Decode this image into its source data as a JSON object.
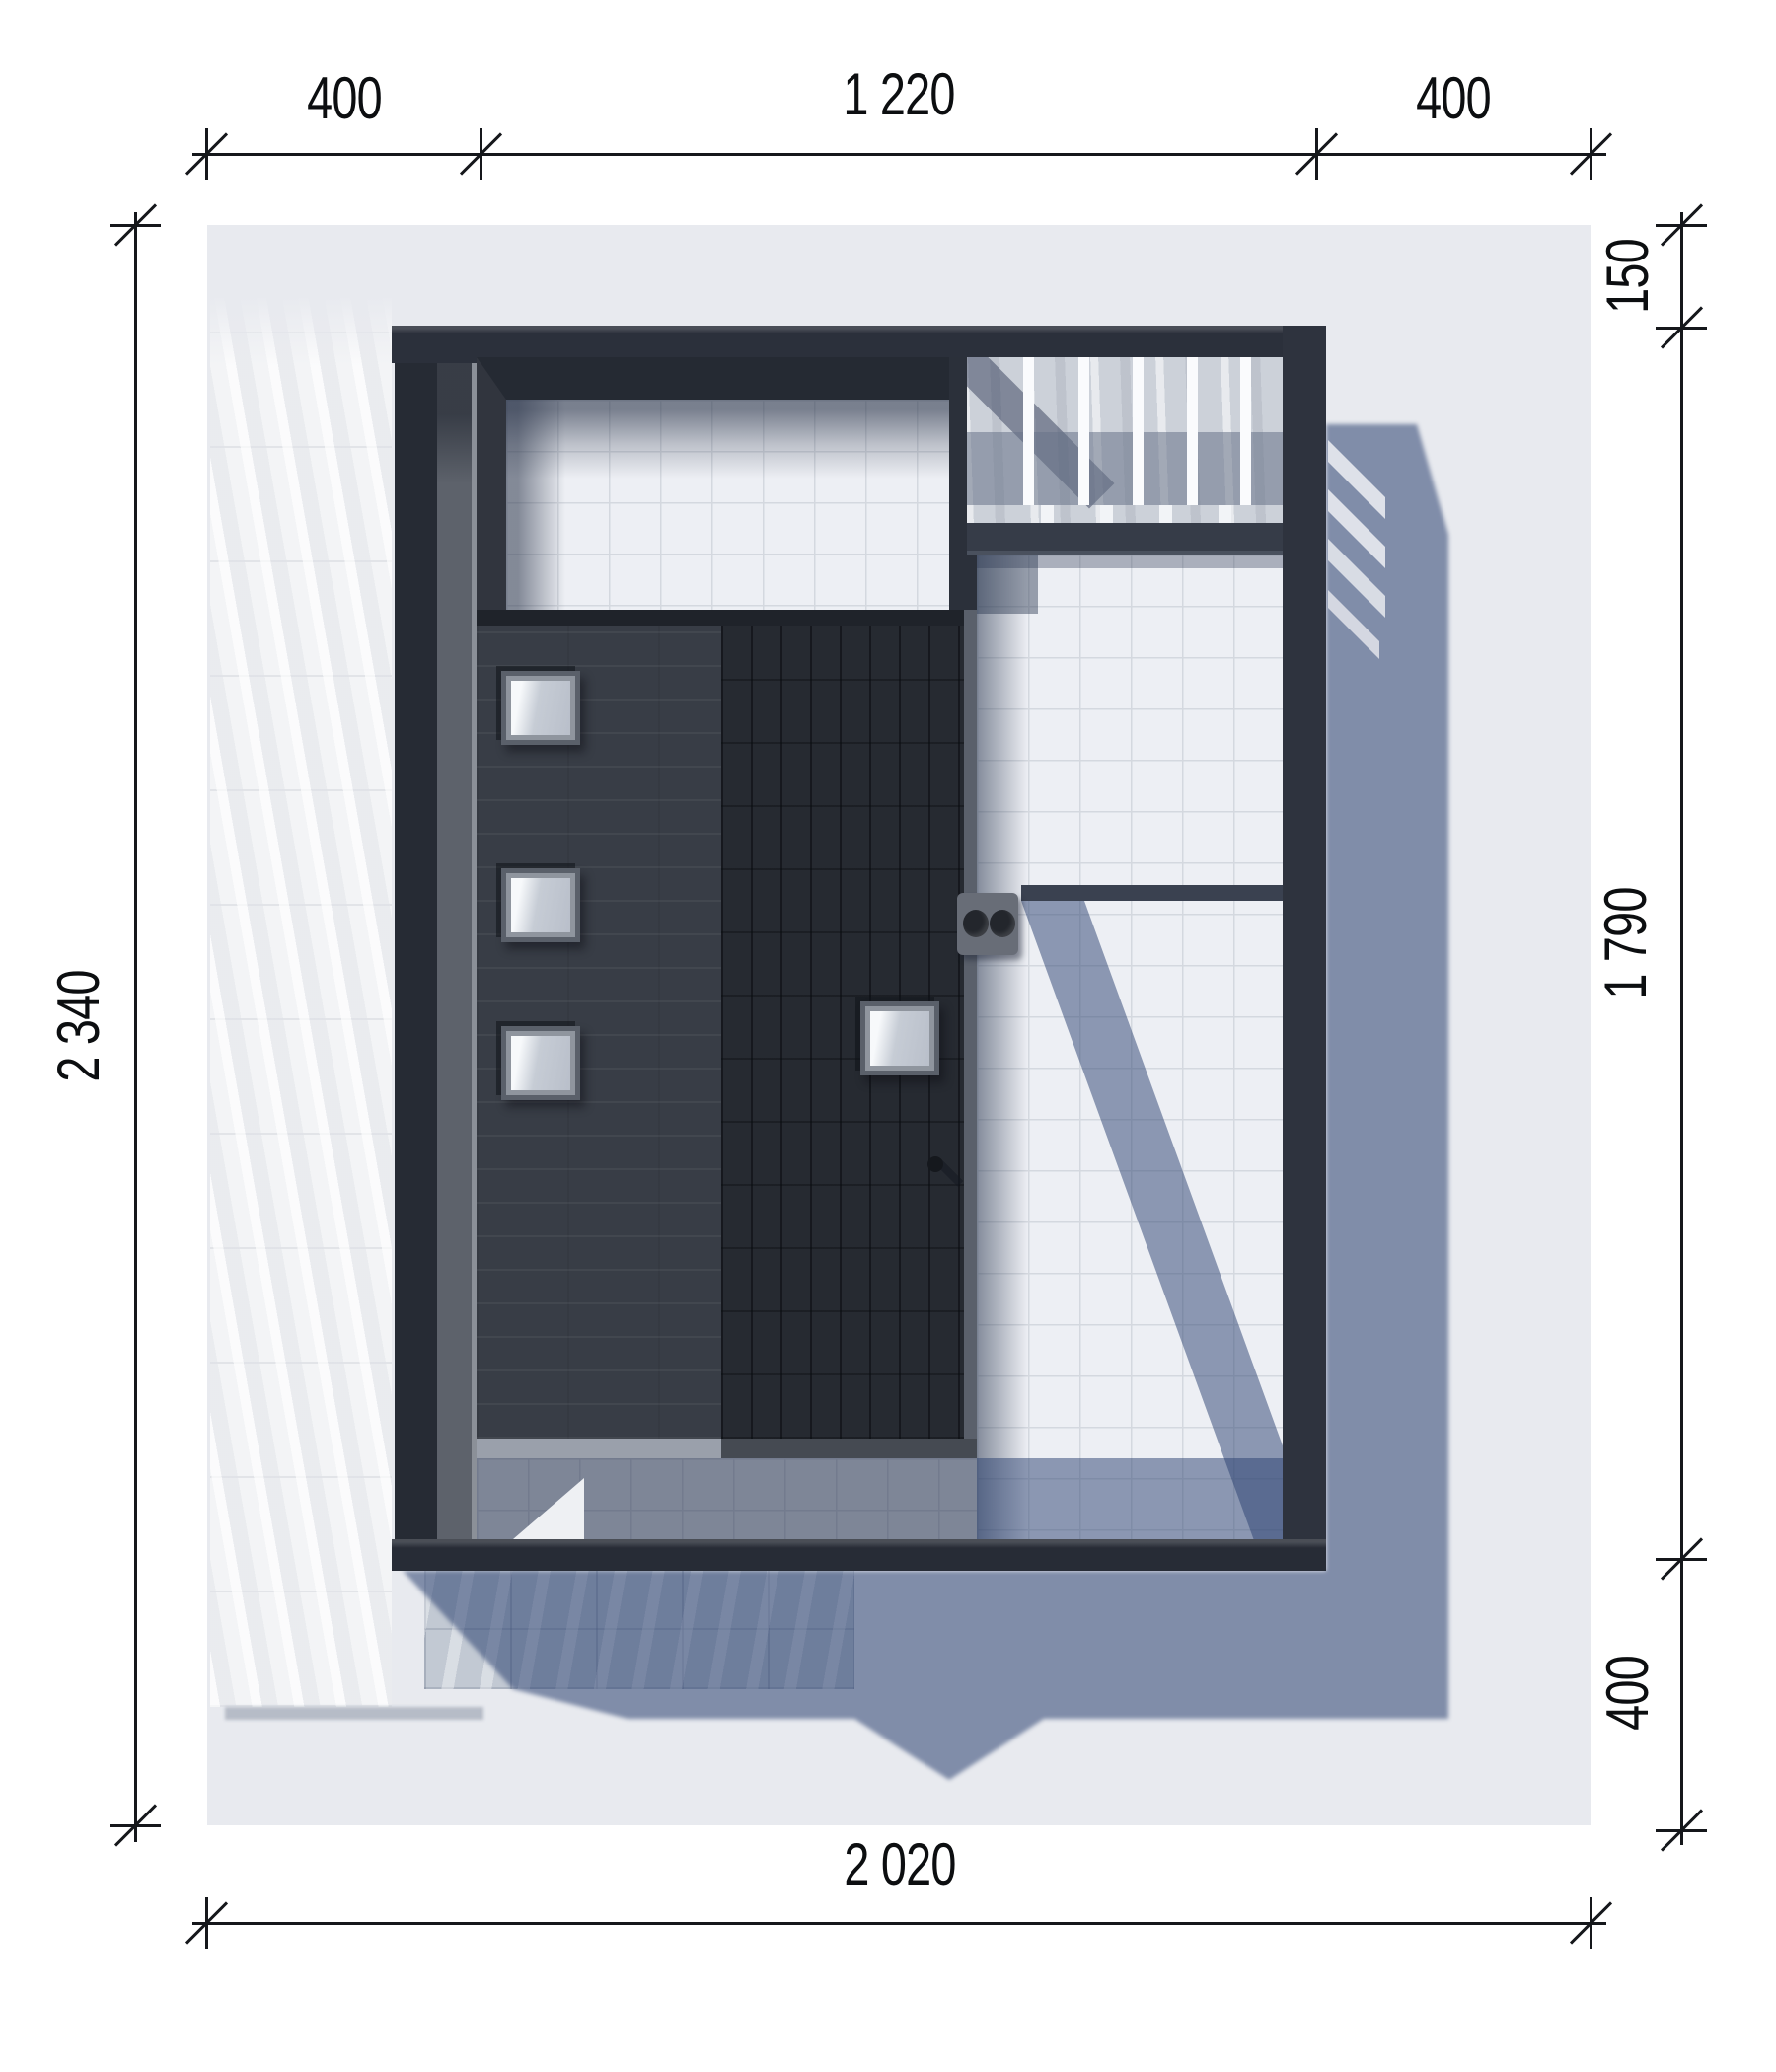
{
  "drawing": {
    "type": "architectural-site-plan",
    "view": "top-down roof plan render with dimension lines",
    "units_shown": "centimeters (implied, unlabeled)"
  },
  "dimensions": {
    "top": {
      "segments": [
        "400",
        "1 220",
        "400"
      ]
    },
    "left": {
      "total": "2 340"
    },
    "right": {
      "segments": [
        "150",
        "1 790",
        "400"
      ]
    },
    "bottom": {
      "total": "2 020"
    }
  },
  "colors": {
    "background": "#ffffff",
    "site": "#e8eaef",
    "dimension_ink": "#15171b",
    "wall_dark": "#2b303b",
    "roof_left_half": "#383d46",
    "roof_right_half": "#262a31",
    "terrace_tile": "#edeff4",
    "tile_grid": "#d4d8df",
    "cast_shadow": "#7487a8",
    "concrete_path": "#f3f4f6",
    "concrete_apron": "#c2c9d3",
    "pergola_slat": "#fafbfd",
    "skylight_glass": "#c9ced6"
  },
  "features": {
    "skylight_count": 4,
    "pergola_slat_count": 5
  }
}
